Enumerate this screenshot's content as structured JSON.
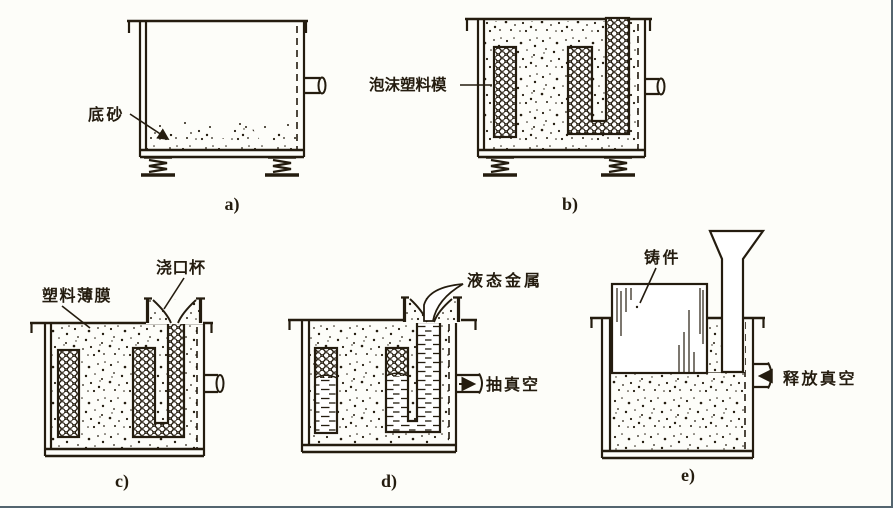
{
  "colors": {
    "ink": "#241c0f",
    "paper": "#fdfdf9",
    "frame_border": "#54656f"
  },
  "icons": {
    "pump_vacuum_arrow": "→",
    "release_vacuum_arrow": "←",
    "label_leader_arrow": "↘"
  },
  "panels": [
    {
      "id": "a",
      "caption": "a)",
      "labels": [
        {
          "text": "底砂"
        }
      ]
    },
    {
      "id": "b",
      "caption": "b)",
      "labels": [
        {
          "text": "泡沫塑料模"
        }
      ]
    },
    {
      "id": "c",
      "caption": "c)",
      "labels": [
        {
          "text": "塑料薄膜"
        },
        {
          "text": "浇口杯"
        }
      ]
    },
    {
      "id": "d",
      "caption": "d)",
      "labels": [
        {
          "text": "液态金属"
        },
        {
          "text": "抽真空"
        }
      ]
    },
    {
      "id": "e",
      "caption": "e)",
      "labels": [
        {
          "text": "铸件"
        },
        {
          "text": "释放真空"
        }
      ]
    }
  ]
}
